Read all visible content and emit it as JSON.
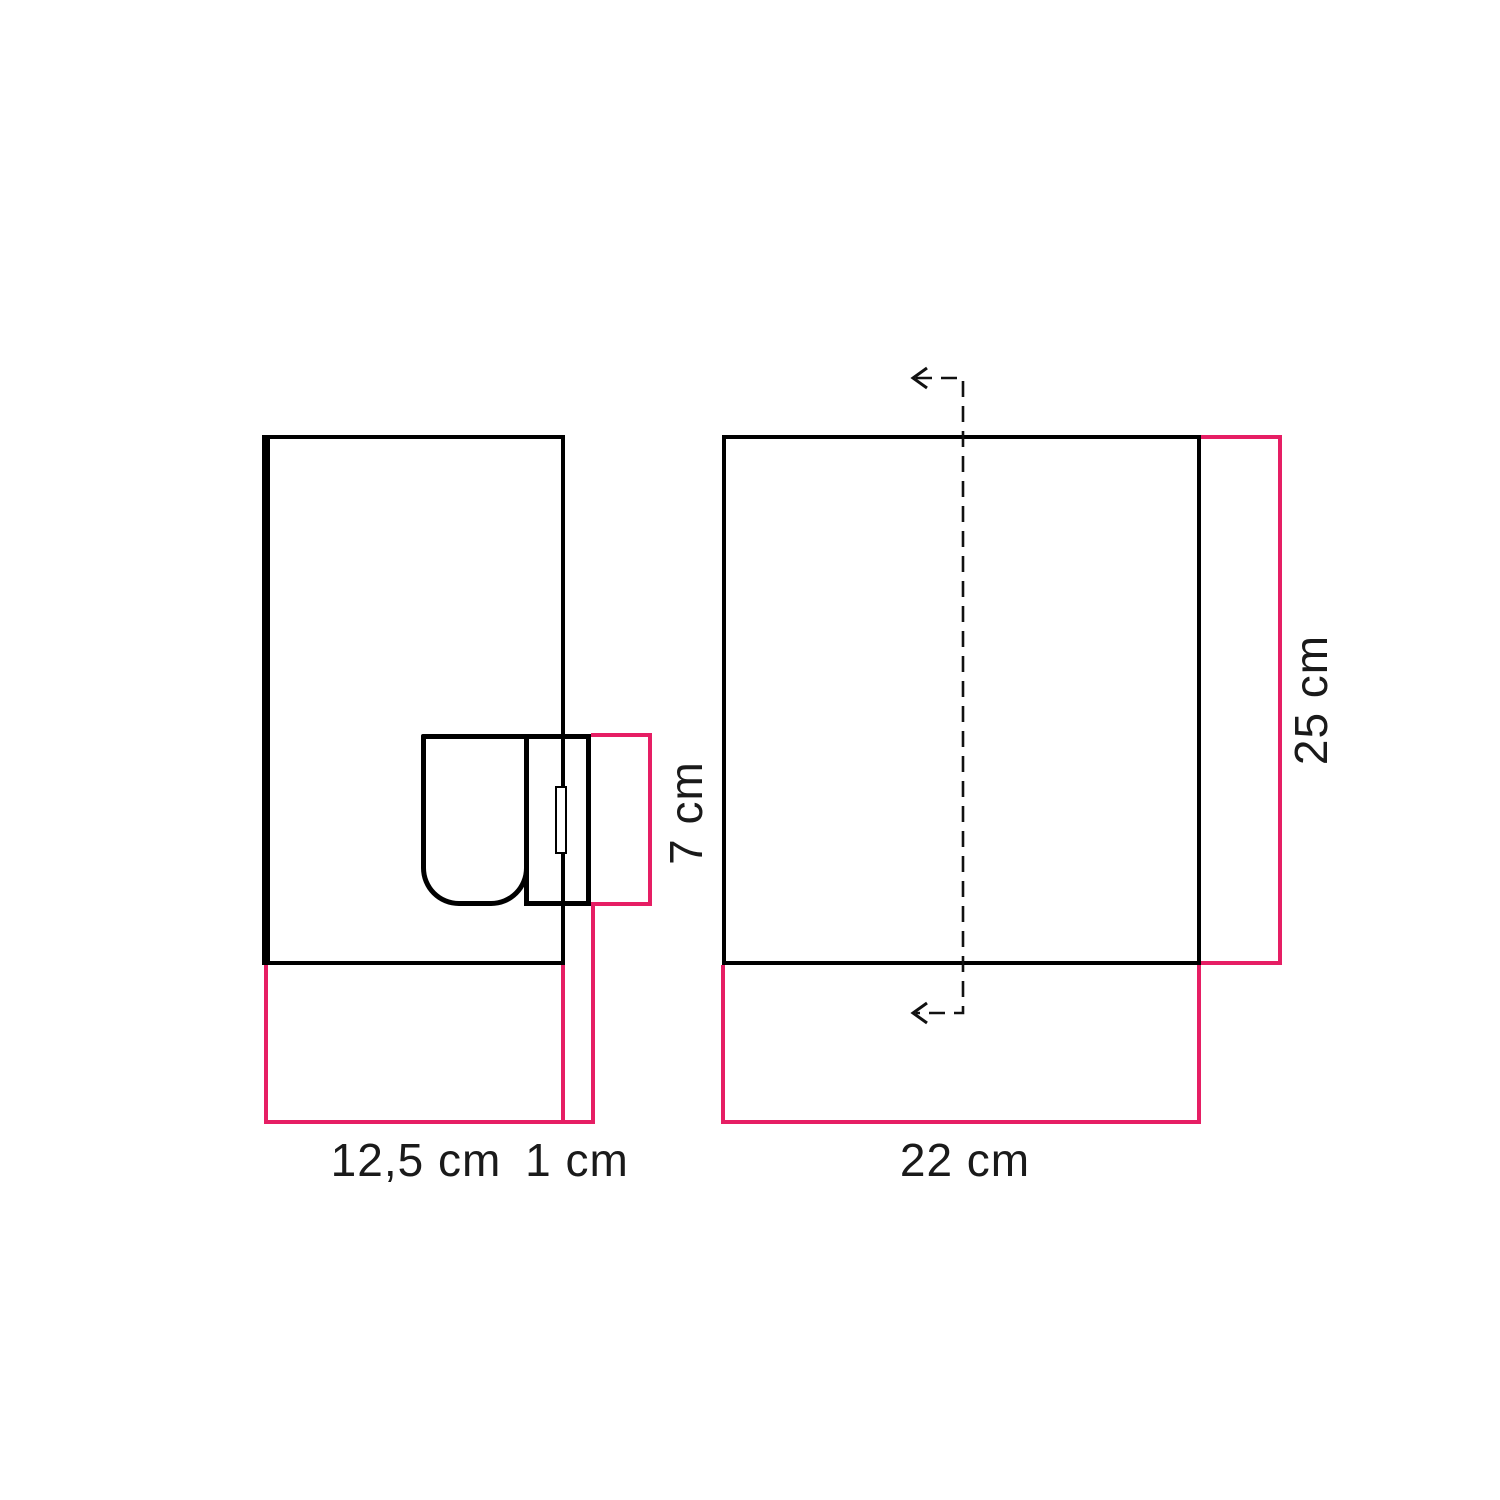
{
  "colors": {
    "outline": "#000000",
    "dimension": "#e61e64",
    "label": "#1a1a1a",
    "background": "#ffffff"
  },
  "side_view": {
    "width_label": "12,5 cm",
    "gap_label": "1 cm",
    "holder_height_label": "7 cm"
  },
  "front_view": {
    "width_label": "22 cm",
    "height_label": "25 cm"
  }
}
